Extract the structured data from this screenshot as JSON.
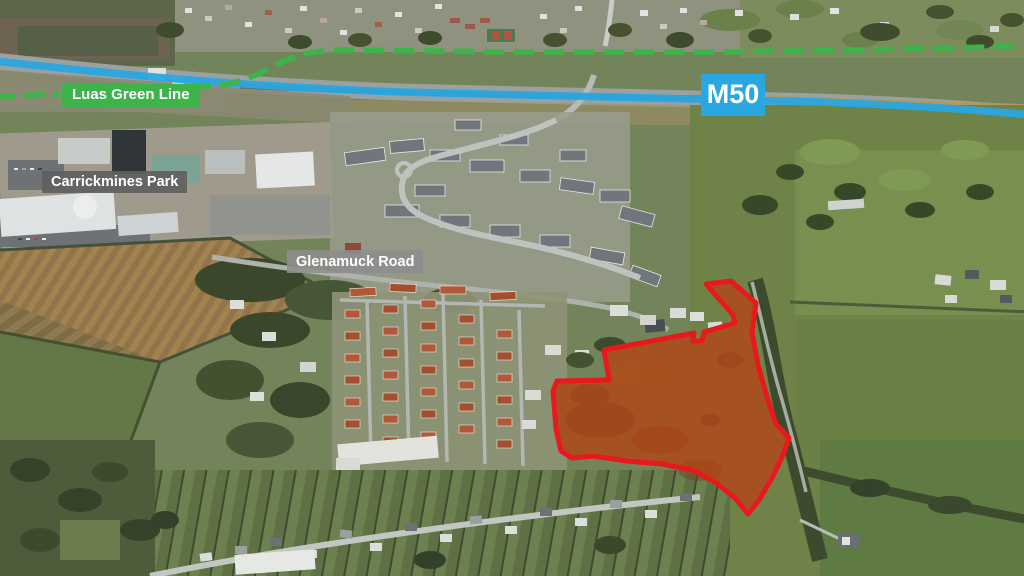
{
  "annotations": {
    "luas_label": "Luas Green Line",
    "m50_label": "M50",
    "carrickmines_label": "Carrickmines Park",
    "glenamuck_label": "Glenamuck Road"
  },
  "colors": {
    "luas_green": "#3cb44a",
    "m50_blue": "#29a7e0",
    "site_outline_red": "#e8191c",
    "site_fill": "rgba(208,62,10,0.55)",
    "carrickmines_label_bg": "rgba(95,95,95,0.92)",
    "glenamuck_label_bg": "rgba(141,141,141,0.88)"
  }
}
